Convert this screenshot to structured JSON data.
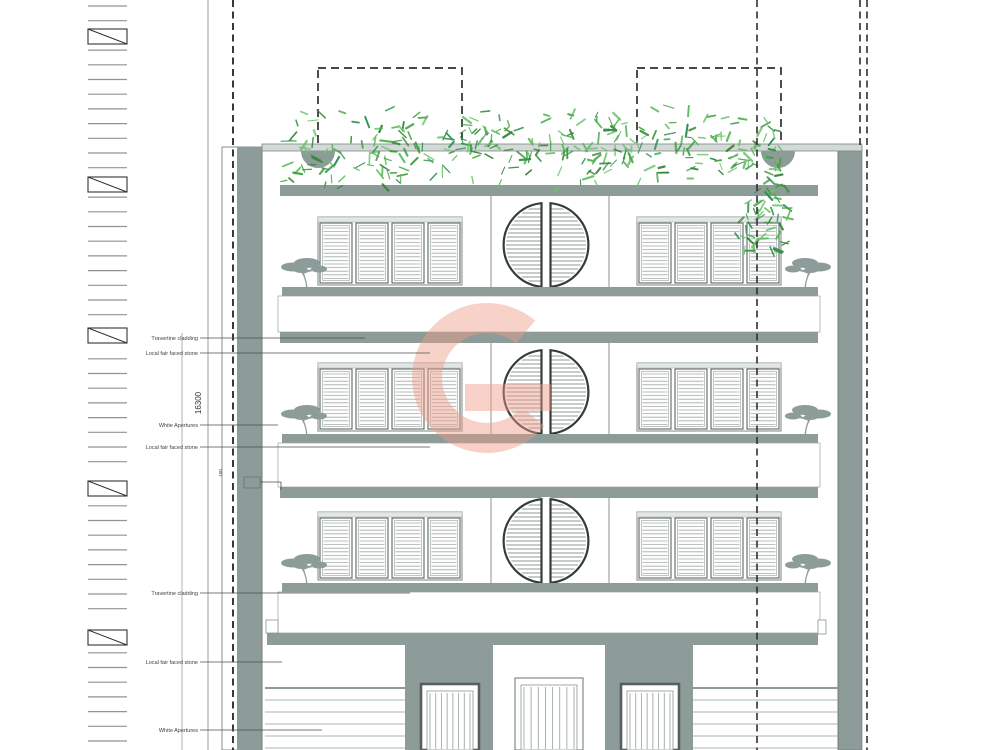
{
  "document": {
    "type": "architectural front elevation drawing",
    "background": "#ffffff"
  },
  "annotations": {
    "material_labels": [
      {
        "text": "Travertine cladding",
        "y": 338,
        "x_end": 365
      },
      {
        "text": "Local fair faced stone",
        "y": 353,
        "x_end": 430
      },
      {
        "text": "White Apertures",
        "y": 425,
        "x_end": 278
      },
      {
        "text": "Local fair faced stone",
        "y": 447,
        "x_end": 430
      },
      {
        "text": "Travertine cladding",
        "y": 593,
        "x_end": 410
      },
      {
        "text": "Local fair faced stone",
        "y": 662,
        "x_end": 282
      },
      {
        "text": "White Apertures",
        "y": 730,
        "x_end": 322
      }
    ],
    "dimensions": [
      {
        "text": "16300",
        "x": 201,
        "y": 403,
        "rotation": -90
      },
      {
        "text": "150",
        "x": 222,
        "y": 473,
        "rotation": -90
      }
    ]
  },
  "watermark": {
    "letter": "G",
    "color": "#ee9b87",
    "opacity": 0.45
  },
  "colors": {
    "structure_gray": "#8d9c99",
    "parapet_gray": "#d3d9d7",
    "outline_gray": "#6a7472",
    "frame_dark": "#56605e",
    "slat_gray": "#a3adab",
    "stone_line_gray": "#aab4b2",
    "grid_line": "#2f2f2f",
    "foliage_greens": [
      "#3f9e3f",
      "#57b957",
      "#2f8f4f",
      "#6cc46c",
      "#358535"
    ]
  }
}
